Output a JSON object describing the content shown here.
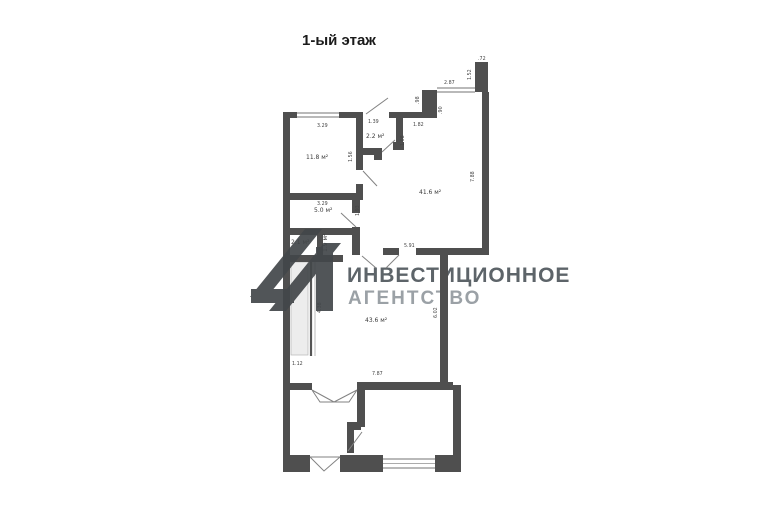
{
  "page": {
    "title": "1-ый этаж"
  },
  "watermark": {
    "line1": "ИНВЕСТИЦИОННОЕ",
    "line2": "АГЕНТСТВО",
    "line1_color": "#5d6469",
    "line2_color": "#9ba1a6",
    "logo_color": "#43474a"
  },
  "floorplan": {
    "wall_color": "#4f4f4f",
    "rooms": [
      {
        "label": "11.8 м²"
      },
      {
        "label": "2.2 м²"
      },
      {
        "label": "41.6 м²"
      },
      {
        "label": "5.0 м²"
      },
      {
        "label": "2.1 м²"
      },
      {
        "label": "1.9 м²"
      },
      {
        "label": "43.6 м²"
      }
    ],
    "dimensions": [
      ".72",
      "1.52",
      "2.87",
      ".98",
      ".90",
      "1.82",
      "3.29",
      "1.39",
      "1.08",
      "1.56",
      "7.88",
      "3.29",
      "1.93",
      "5.91",
      "4.38",
      "1.12",
      "6.02",
      "7.87"
    ]
  }
}
